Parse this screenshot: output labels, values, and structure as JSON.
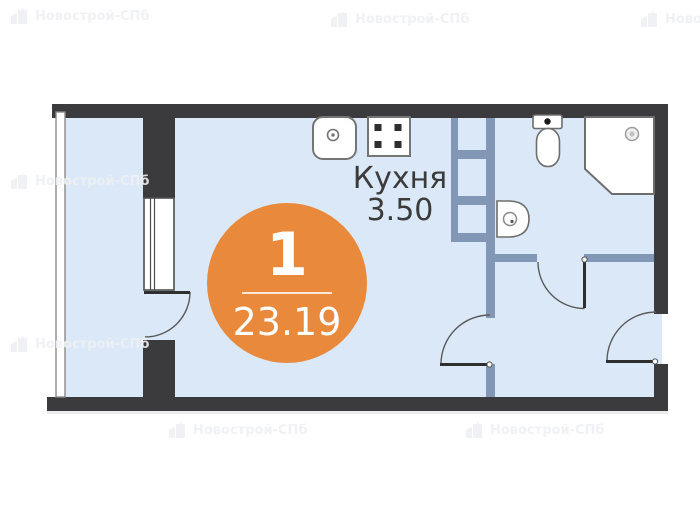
{
  "watermark": {
    "brand": "Новострой-СПб"
  },
  "floor_plan": {
    "unit_badge": {
      "number": "1",
      "area": "23.19"
    },
    "kitchen": {
      "name": "Кухня",
      "area": "3.50"
    },
    "fixtures": [
      "kitchen-sink",
      "stove",
      "toilet",
      "washbasin",
      "shower-tray",
      "vent-shaft"
    ],
    "colors": {
      "badge_orange": "#e8893b",
      "room_fill": "#dbe8f7",
      "wall_dark": "#3b3b3d",
      "wall_interior": "#8296b5",
      "label_text": "#3b3b3b",
      "watermark": "#eef0f3"
    }
  }
}
